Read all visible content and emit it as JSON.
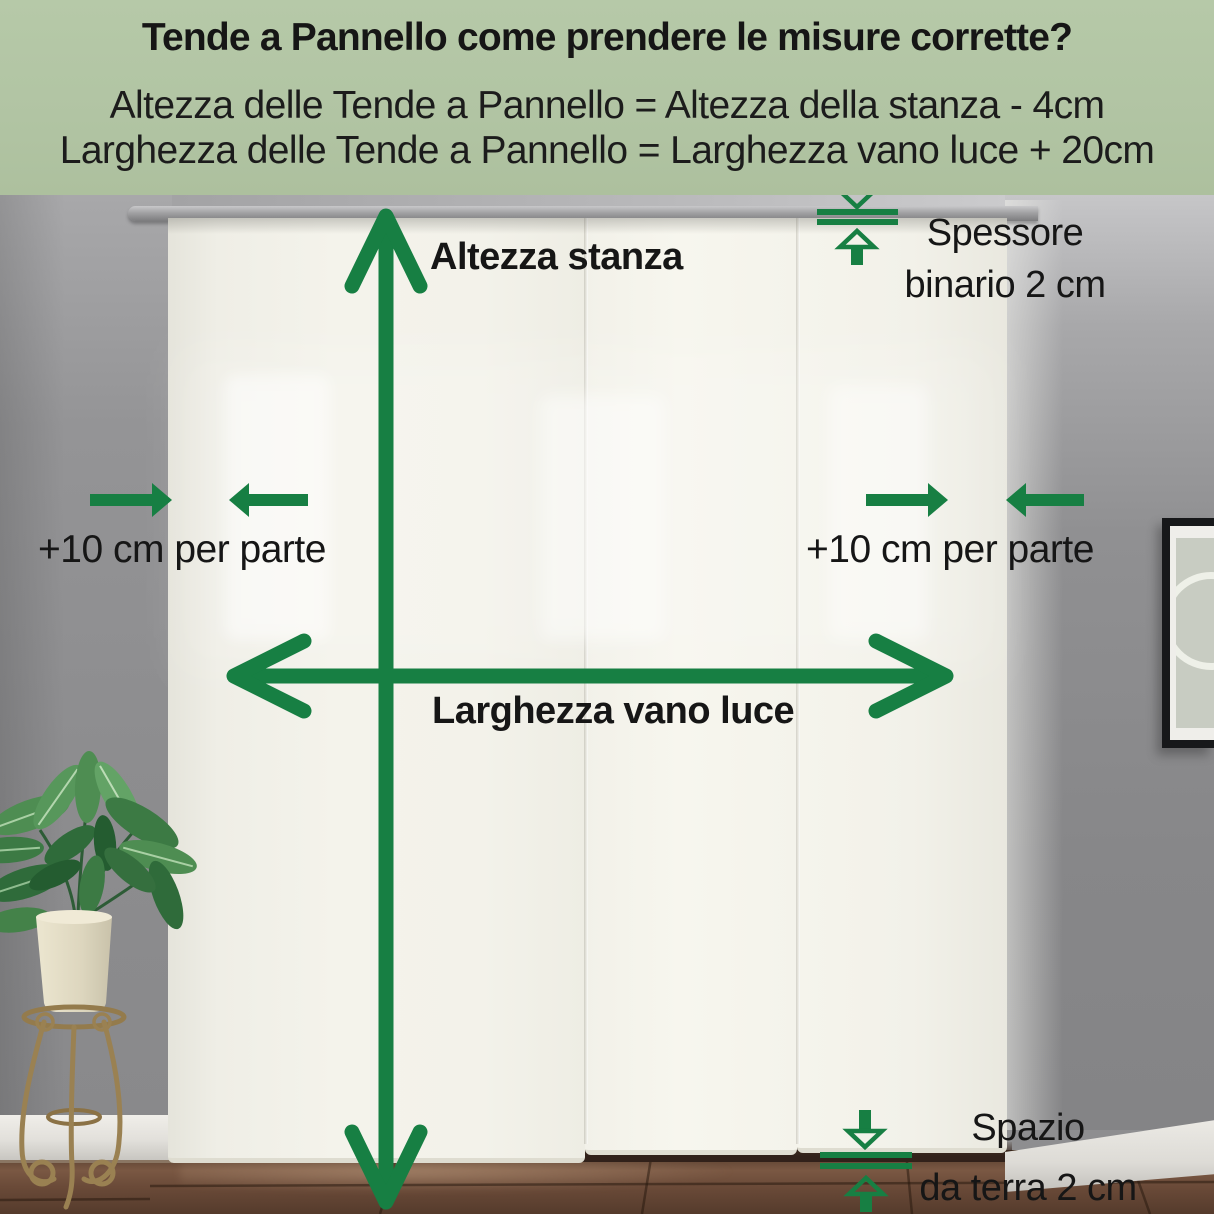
{
  "colors": {
    "accent": "#177f43",
    "header_bg": "#b1c4a3",
    "text": "#161616"
  },
  "header": {
    "title": "Tende a Pannello come prendere le misure corrette?",
    "formula_height": "Altezza delle Tende a Pannello = Altezza della stanza - 4cm",
    "formula_width": "Larghezza delle Tende a Pannello = Larghezza vano luce + 20cm"
  },
  "annotations": {
    "room_height": "Altezza stanza",
    "opening_width": "Larghezza vano luce",
    "left_allowance": "+10 cm per parte",
    "right_allowance": "+10 cm per parte",
    "track_thickness_line1": "Spessore",
    "track_thickness_line2": "binario 2 cm",
    "floor_gap_line1": "Spazio",
    "floor_gap_line2": "da terra 2 cm"
  }
}
